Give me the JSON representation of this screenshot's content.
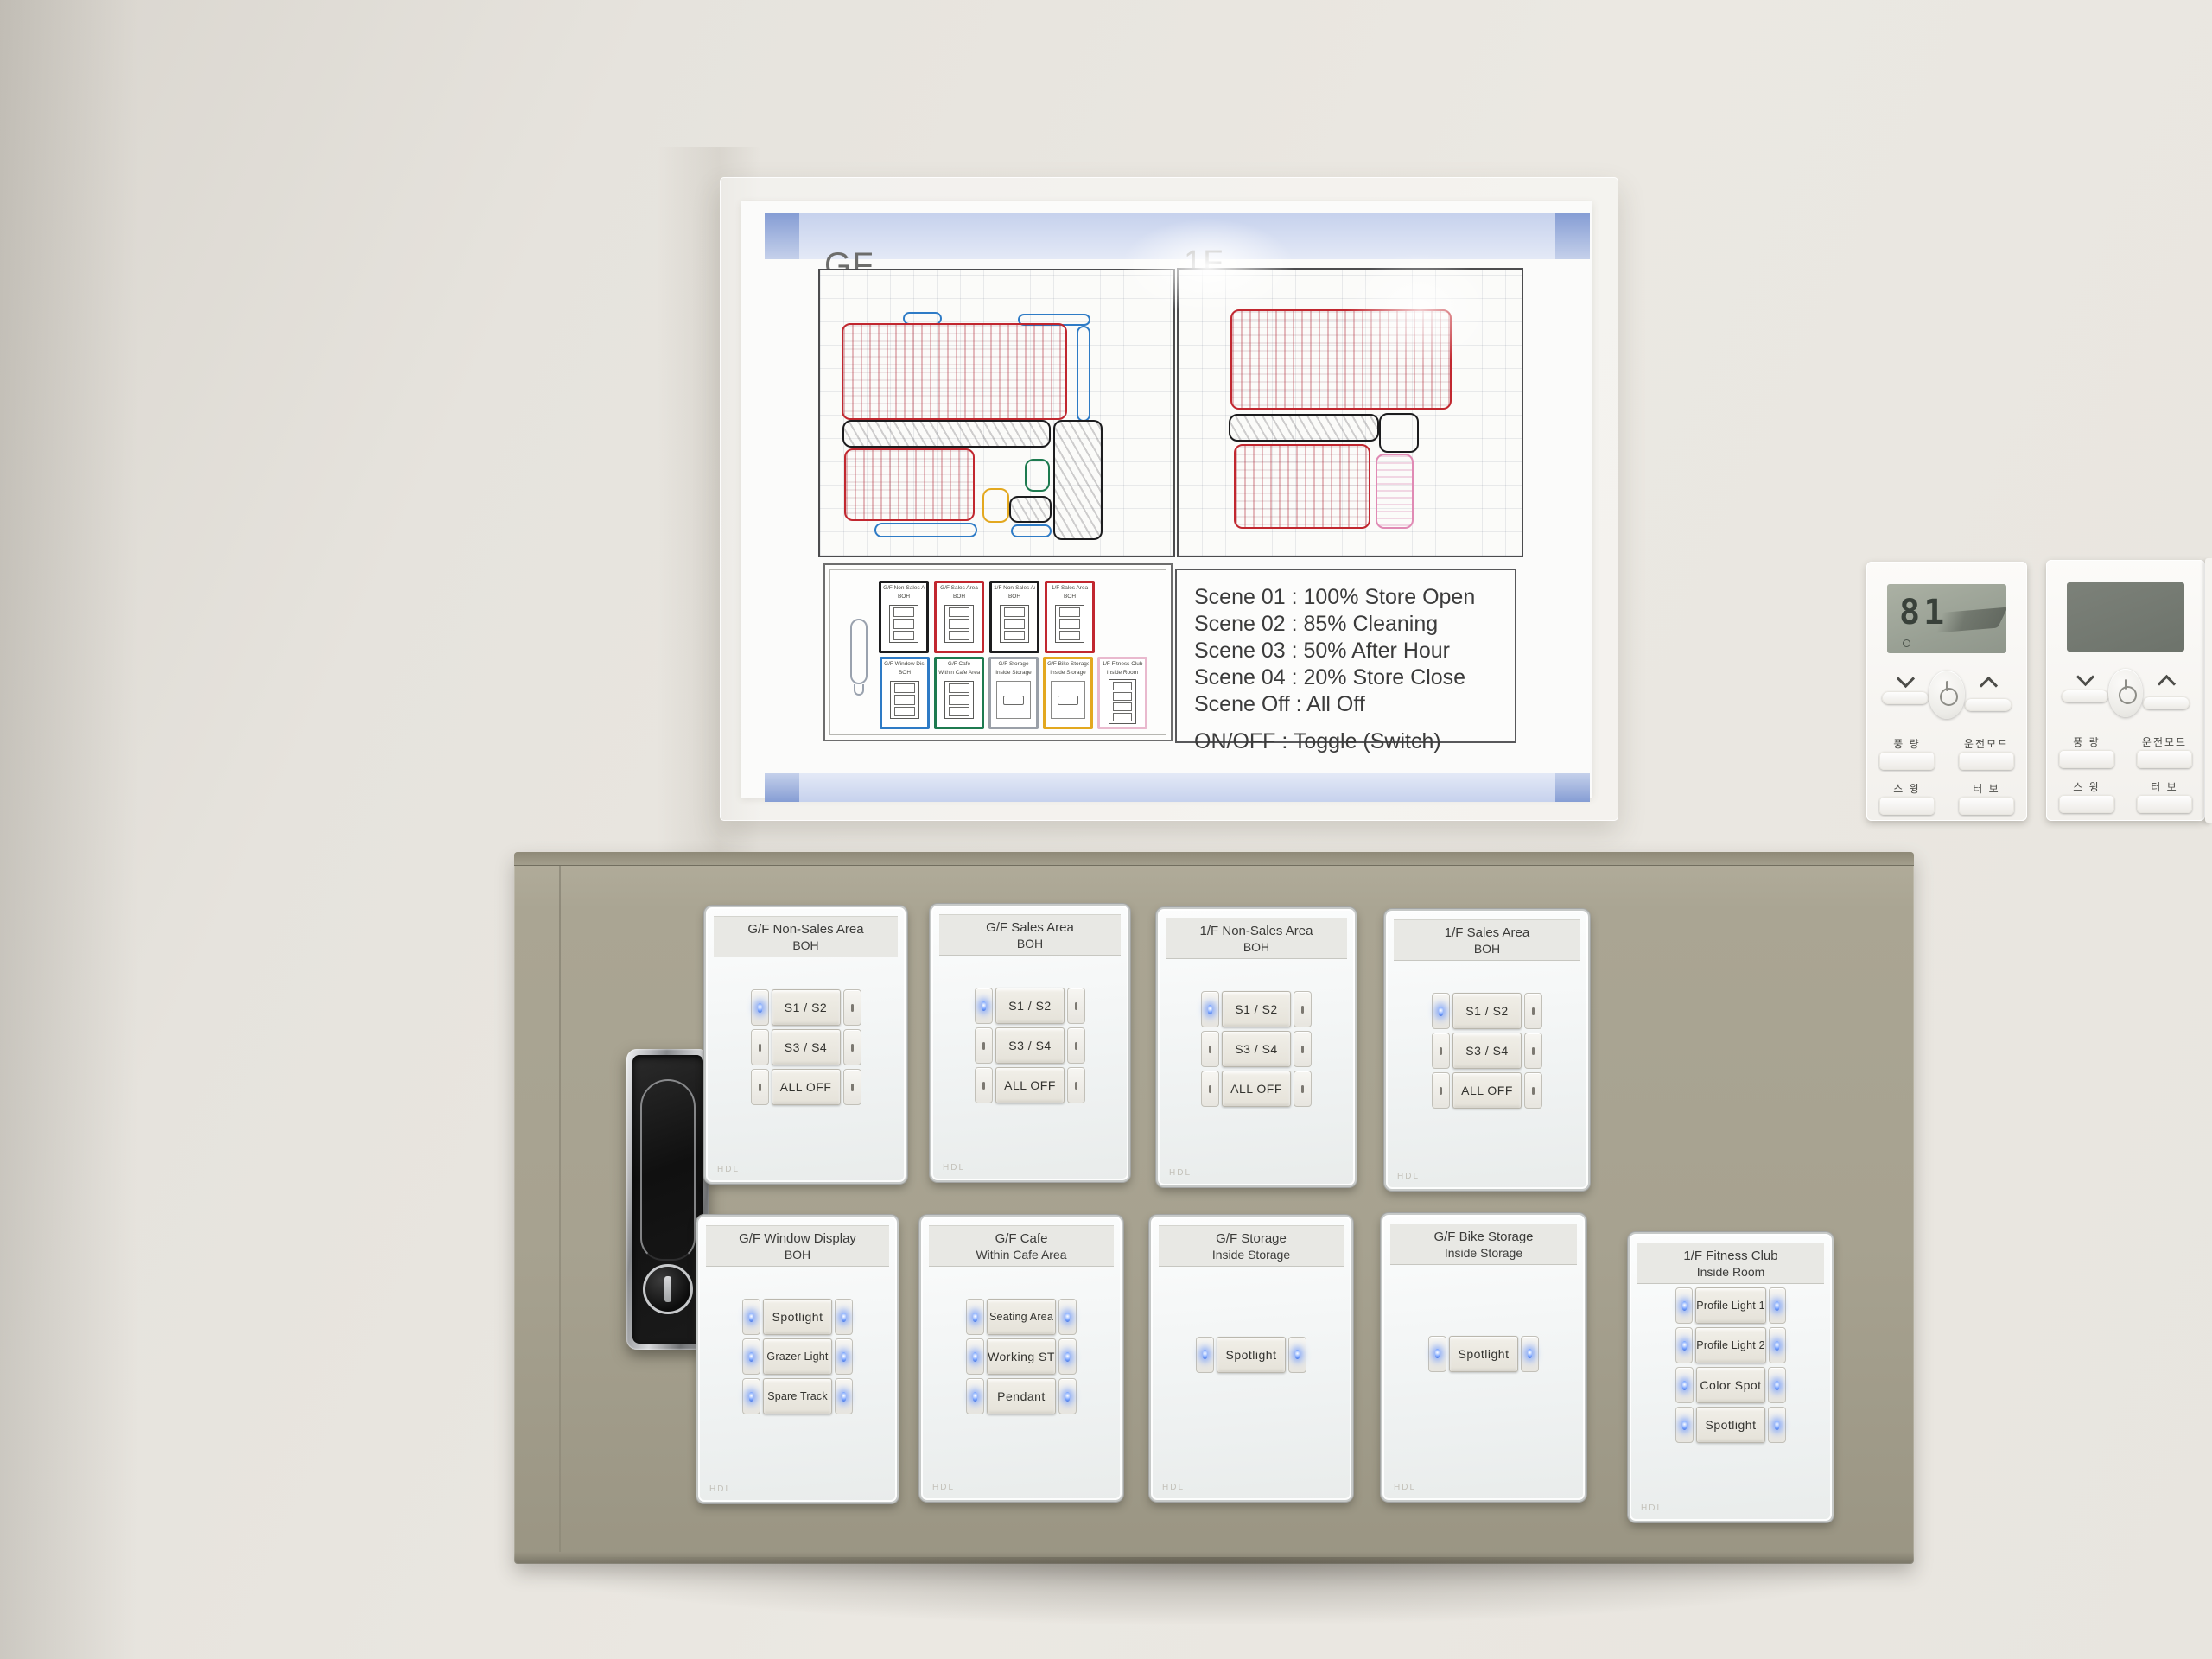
{
  "poster": {
    "gf_label": "GF",
    "f1_label": "1F",
    "scene_lines": [
      "Scene 01 : 100% Store Open",
      "Scene 02 :  85% Cleaning",
      "Scene 03 :  50% After Hour",
      "Scene 04 :  20% Store Close",
      "Scene Off :  All Off"
    ],
    "onoff_line": "ON/OFF  :  Toggle (Switch)",
    "legend_panels": [
      {
        "line1": "G/F Non-Sales Area",
        "line2": "BOH",
        "color": "#1c1c1e",
        "type": "three"
      },
      {
        "line1": "G/F Sales Area",
        "line2": "BOH",
        "color": "#c1272f",
        "type": "three"
      },
      {
        "line1": "1/F Non-Sales Area",
        "line2": "BOH",
        "color": "#1c1c1e",
        "type": "three"
      },
      {
        "line1": "1/F Sales Area",
        "line2": "BOH",
        "color": "#c1272f",
        "type": "three"
      },
      {
        "line1": "G/F Window Display",
        "line2": "BOH",
        "color": "#2e7bc6",
        "type": "three"
      },
      {
        "line1": "G/F Cafe",
        "line2": "Within Cafe Area",
        "color": "#1d7a4f",
        "type": "three"
      },
      {
        "line1": "G/F Storage",
        "line2": "Inside Storage",
        "color": "#9aa0a8",
        "type": "one"
      },
      {
        "line1": "G/F Bike Storage",
        "line2": "Inside Storage",
        "color": "#e3a81f",
        "type": "one"
      },
      {
        "line1": "1/F Fitness Club",
        "line2": "Inside Room",
        "color": "#e9b9ce",
        "type": "four"
      }
    ],
    "floorplans": [
      {
        "label": "GF",
        "zones": [
          {
            "c": "#2e7bc6",
            "x": 23.5,
            "y": 14.5,
            "w": 11,
            "h": 4.5,
            "hatch": ""
          },
          {
            "c": "#2e7bc6",
            "x": 56,
            "y": 15,
            "w": 20.5,
            "h": 4.5,
            "hatch": ""
          },
          {
            "c": "#c1272f",
            "x": 6,
            "y": 18.5,
            "w": 64,
            "h": 34,
            "hatch": "red"
          },
          {
            "c": "#2e7bc6",
            "x": 72.5,
            "y": 19.5,
            "w": 4,
            "h": 33.5,
            "hatch": ""
          },
          {
            "c": "#1c1c1e",
            "x": 6.3,
            "y": 52.5,
            "w": 59,
            "h": 9.5,
            "hatch": "dark"
          },
          {
            "c": "#c1272f",
            "x": 6.8,
            "y": 62.5,
            "w": 37,
            "h": 25.5,
            "hatch": "red"
          },
          {
            "c": "#e3a81f",
            "x": 46,
            "y": 76.5,
            "w": 7.5,
            "h": 12,
            "hatch": ""
          },
          {
            "c": "#1d7a4f",
            "x": 58,
            "y": 66,
            "w": 7,
            "h": 11.5,
            "hatch": ""
          },
          {
            "c": "#1c1c1e",
            "x": 53.5,
            "y": 79,
            "w": 12,
            "h": 9.5,
            "hatch": "dark"
          },
          {
            "c": "#1c1c1e",
            "x": 66,
            "y": 52.5,
            "w": 14,
            "h": 42,
            "hatch": "dark"
          },
          {
            "c": "#2e7bc6",
            "x": 15.5,
            "y": 88.5,
            "w": 29,
            "h": 5,
            "hatch": ""
          },
          {
            "c": "#2e7bc6",
            "x": 54,
            "y": 89,
            "w": 11.5,
            "h": 4.5,
            "hatch": ""
          }
        ]
      },
      {
        "label": "1F",
        "zones": [
          {
            "c": "#c1272f",
            "x": 15,
            "y": 14,
            "w": 64.5,
            "h": 35,
            "hatch": "red"
          },
          {
            "c": "#1c1c1e",
            "x": 14.5,
            "y": 50.5,
            "w": 44,
            "h": 9.5,
            "hatch": "dark"
          },
          {
            "c": "#1c1c1e",
            "x": 58.5,
            "y": 50,
            "w": 11.5,
            "h": 14,
            "hatch": ""
          },
          {
            "c": "#c1272f",
            "x": 16,
            "y": 61,
            "w": 40,
            "h": 29.5,
            "hatch": "red"
          },
          {
            "c": "#e08ab4",
            "x": 57.5,
            "y": 64.5,
            "w": 11,
            "h": 26,
            "hatch": "pink"
          }
        ]
      }
    ]
  },
  "controllers": {
    "display_value": "81",
    "button_labels": {
      "fan": "풍 량",
      "mode": "운전모드",
      "swing": "스 윙",
      "turbo": "터 보"
    }
  },
  "cabinet": {
    "brand": "HDL",
    "led_color": "#5b8dff",
    "panels": [
      {
        "line1": "G/F Non-Sales Area",
        "line2": "BOH",
        "buttons": [
          "S1 / S2",
          "S3 / S4",
          "ALL OFF"
        ],
        "led_mode": "first-left"
      },
      {
        "line1": "G/F Sales Area",
        "line2": "BOH",
        "buttons": [
          "S1 / S2",
          "S3 / S4",
          "ALL OFF"
        ],
        "led_mode": "first-left"
      },
      {
        "line1": "1/F Non-Sales Area",
        "line2": "BOH",
        "buttons": [
          "S1 / S2",
          "S3 / S4",
          "ALL OFF"
        ],
        "led_mode": "first-left"
      },
      {
        "line1": "1/F Sales Area",
        "line2": "BOH",
        "buttons": [
          "S1 / S2",
          "S3 / S4",
          "ALL OFF"
        ],
        "led_mode": "first-left"
      },
      {
        "line1": "G/F Window Display",
        "line2": "BOH",
        "buttons": [
          "Spotlight",
          "Grazer Light",
          "Spare Track"
        ],
        "led_mode": "all"
      },
      {
        "line1": "G/F Cafe",
        "line2": "Within Cafe Area",
        "buttons": [
          "Seating Area",
          "Working ST",
          "Pendant"
        ],
        "led_mode": "all"
      },
      {
        "line1": "G/F Storage",
        "line2": "Inside Storage",
        "buttons": [
          "Spotlight"
        ],
        "led_mode": "all"
      },
      {
        "line1": "G/F Bike Storage",
        "line2": "Inside Storage",
        "buttons": [
          "Spotlight"
        ],
        "led_mode": "all"
      },
      {
        "line1": "1/F Fitness Club",
        "line2": "Inside Room",
        "buttons": [
          "Profile Light 1",
          "Profile Light 2",
          "Color Spot",
          "Spotlight"
        ],
        "led_mode": "all"
      }
    ]
  }
}
